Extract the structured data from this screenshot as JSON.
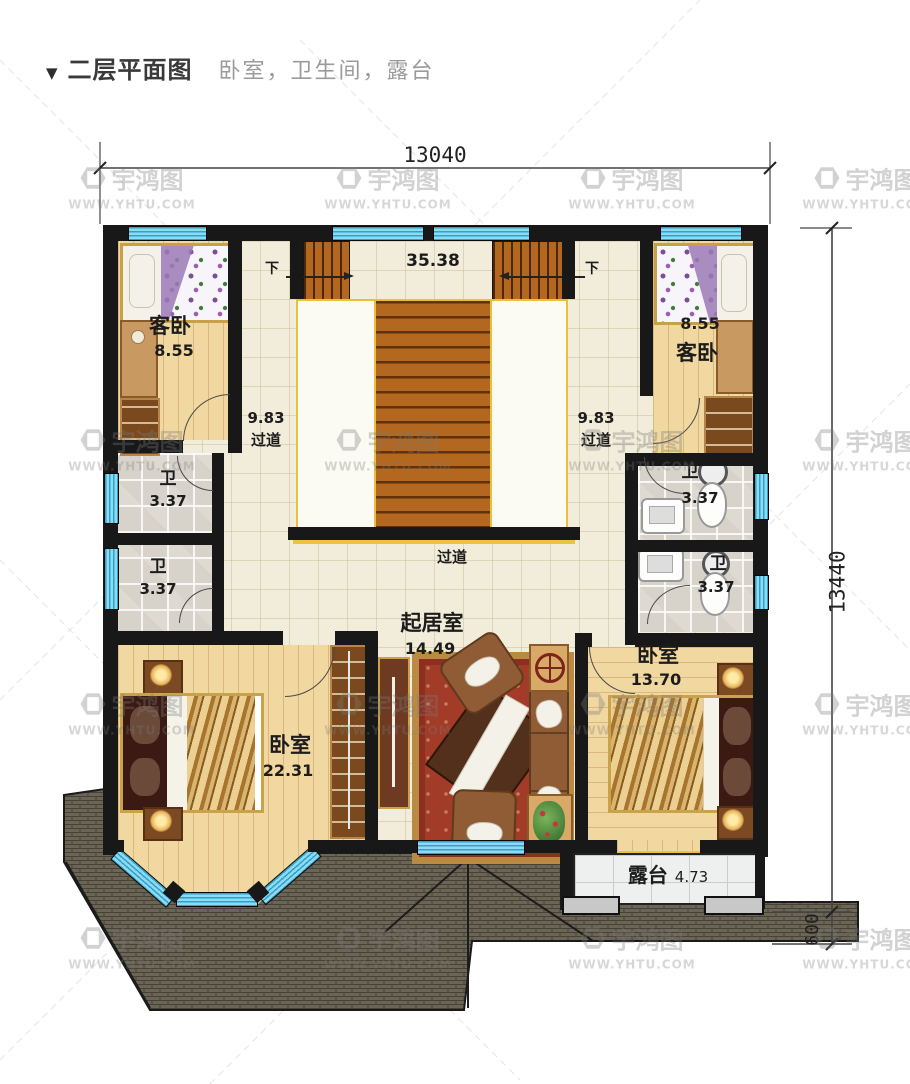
{
  "header": {
    "marker": "▼",
    "title": "二层平面图",
    "subtitle": "卧室，卫生间，露台"
  },
  "dimensions": {
    "overall_width": "13040",
    "overall_height": "13440",
    "terrace_depth": "600"
  },
  "stairwell": {
    "area": "35.38",
    "down_label_left": "下",
    "down_label_right": "下"
  },
  "rooms": {
    "guest_bedroom_left": {
      "name": "客卧",
      "area": "8.55"
    },
    "guest_bedroom_right": {
      "name": "客卧",
      "area": "8.55"
    },
    "corridor_left": {
      "name": "过道",
      "area": "9.83"
    },
    "corridor_right": {
      "name": "过道",
      "area": "9.83"
    },
    "bathroom_left_upper": {
      "name": "卫",
      "area": "3.37"
    },
    "bathroom_left_lower": {
      "name": "卫",
      "area": "3.37"
    },
    "bathroom_right_upper": {
      "name": "卫",
      "area": "3.37"
    },
    "bathroom_right_lower": {
      "name": "卫",
      "area": "3.37"
    },
    "hallway": {
      "name": "过道"
    },
    "living_room": {
      "name": "起居室",
      "area": "14.49"
    },
    "bedroom_left": {
      "name": "卧室",
      "area": "22.31"
    },
    "bedroom_right": {
      "name": "卧室",
      "area": "13.70"
    },
    "terrace": {
      "name": "露台",
      "area": "4.73"
    }
  },
  "watermark": {
    "brand": "宇鸿图",
    "site": "WWW.YHTU.COM"
  },
  "colors": {
    "wall": "#181818",
    "window": "#7fd2ee",
    "stair": "#b4671e",
    "sill": "#edc23f",
    "roof": "#6b6557",
    "rug": "#a23b28",
    "floor_wood": "#f1d7a0",
    "floor_tile": "#f2edda",
    "bath_tile": "#d8d3ca"
  }
}
